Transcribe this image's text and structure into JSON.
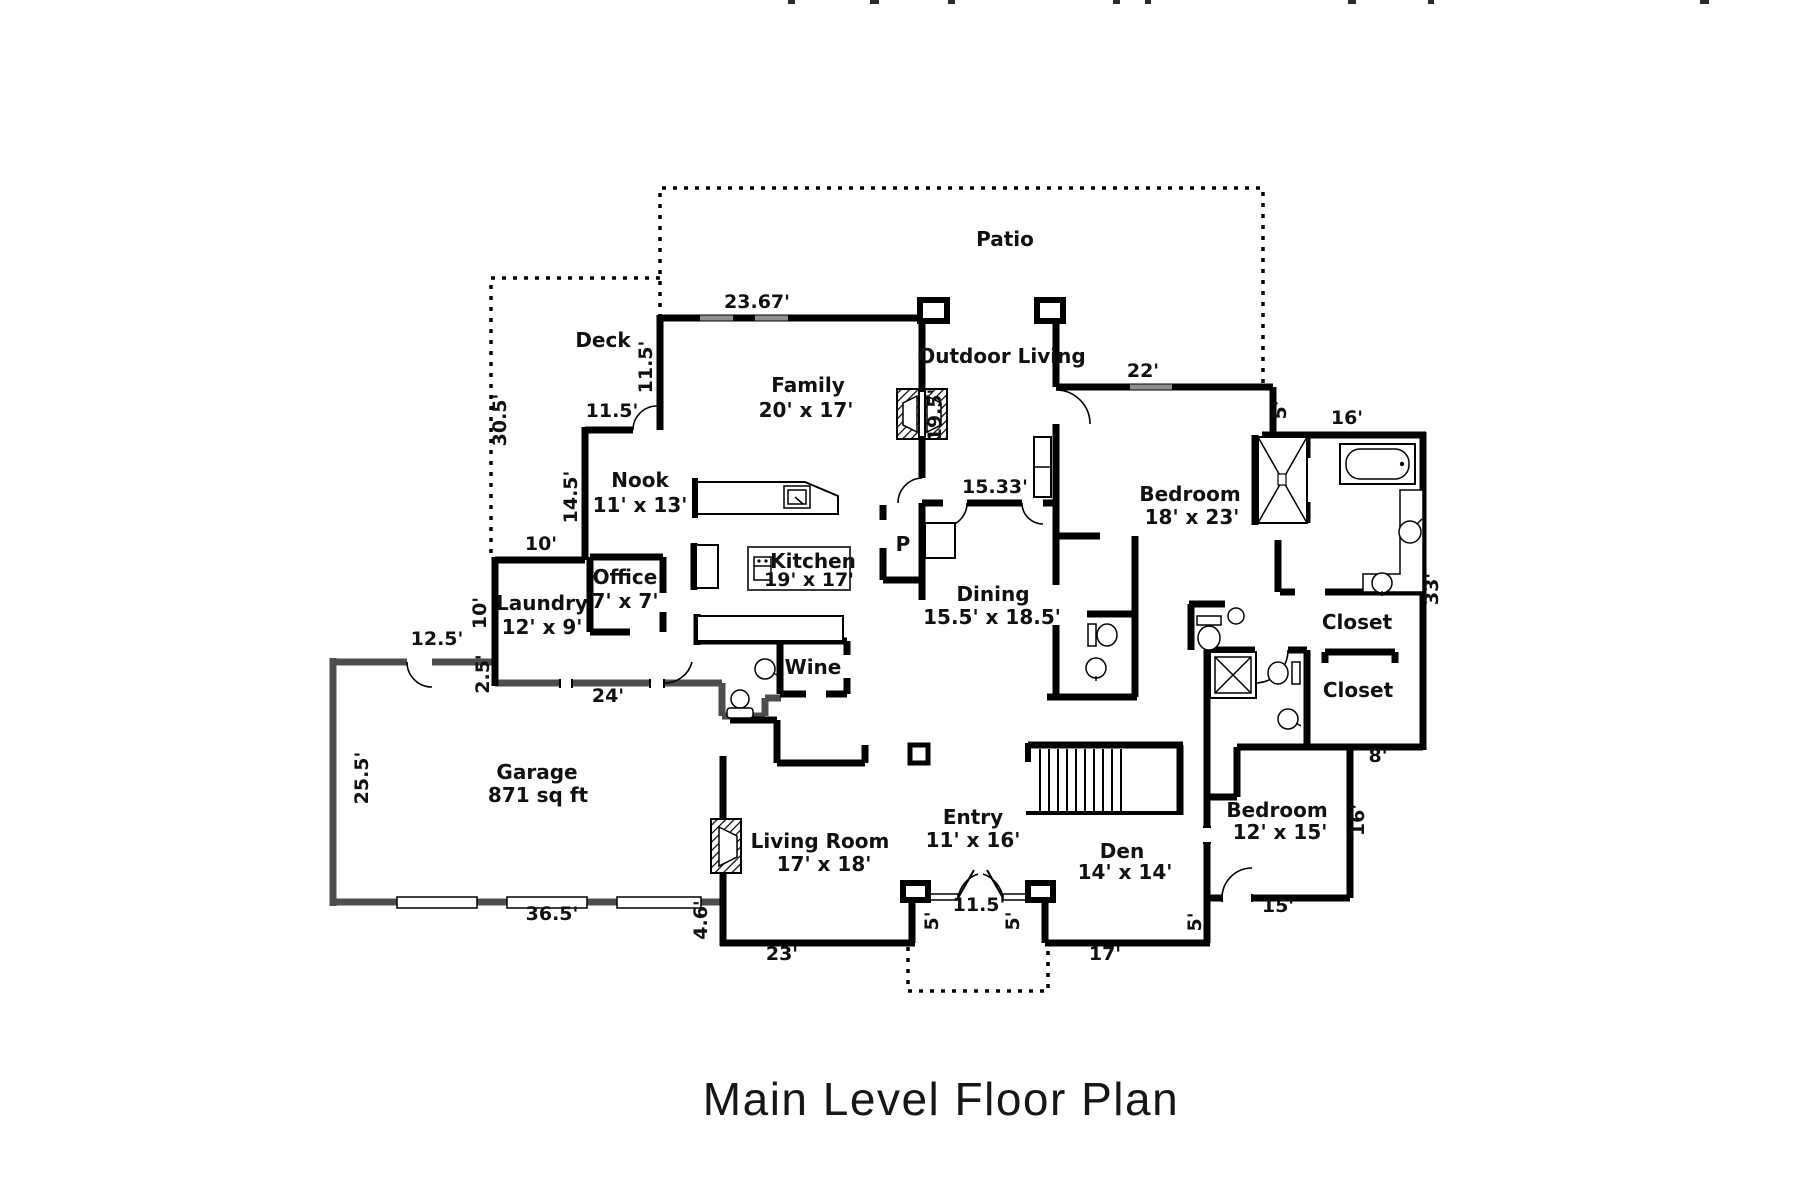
{
  "title": "Main Level Floor Plan",
  "rooms": {
    "patio": {
      "name": "Patio"
    },
    "deck": {
      "name": "Deck"
    },
    "family": {
      "name": "Family",
      "dims": "20' x 17'"
    },
    "outdoor_living": {
      "name": "Outdoor Living"
    },
    "nook": {
      "name": "Nook",
      "dims": "11' x 13'"
    },
    "kitchen": {
      "name": "Kitchen",
      "dims": "19' x 17'"
    },
    "office": {
      "name": "Office",
      "dims": "7' x 7'"
    },
    "laundry": {
      "name": "Laundry",
      "dims": "12' x 9'"
    },
    "pantry": {
      "name": "P"
    },
    "wine": {
      "name": "Wine"
    },
    "dining": {
      "name": "Dining",
      "dims": "15.5' x 18.5'"
    },
    "bedroom_master": {
      "name": "Bedroom",
      "dims": "18' x 23'"
    },
    "closet_master_1": {
      "name": "Closet"
    },
    "closet_master_2": {
      "name": "Closet"
    },
    "garage": {
      "name": "Garage",
      "dims": "871 sq ft"
    },
    "living_room": {
      "name": "Living Room",
      "dims": "17' x 18'"
    },
    "entry": {
      "name": "Entry",
      "dims": "11' x 16'"
    },
    "den": {
      "name": "Den",
      "dims": "14' x 14'"
    },
    "bedroom_2": {
      "name": "Bedroom",
      "dims": "12' x 15'"
    }
  },
  "dimensions": {
    "family_top": "23.67'",
    "deck_side": "30.5'",
    "family_left": "11.5'",
    "nook_top": "11.5'",
    "nook_left": "14.5'",
    "laundry_top": "10'",
    "laundry_left": "10'",
    "garage_top": "12.5'",
    "laundry_jog": "2.5'",
    "hall_wall": "24'",
    "garage_left": "25.5'",
    "garage_bottom": "36.5'",
    "living_jog": "4.6'",
    "living_bottom": "23'",
    "entry_width": "11.5'",
    "entry_side_left": "5'",
    "entry_side_right": "5'",
    "den_bottom": "17'",
    "den_side": "5'",
    "bedroom2_bottom": "15'",
    "bedroom2_side": "16'",
    "closet_bottom": "8'",
    "east_side": "33'",
    "bath_top": "16'",
    "bath_jog": "5'",
    "bedroom_top": "22'",
    "dining_top": "15.33'",
    "fireplace_wall": "19.5'"
  },
  "colors": {
    "wall": "#000000",
    "garage_wall": "#4d4d4d",
    "window": "#8f8f8f",
    "text": "#111111"
  }
}
